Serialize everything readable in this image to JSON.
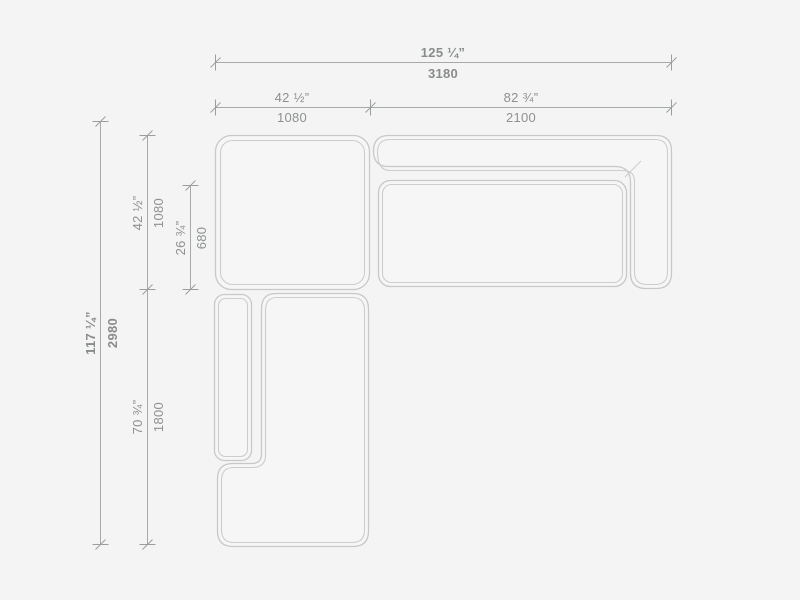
{
  "drawing": {
    "type": "sectional-sofa-top-view-dimension-drawing",
    "units": [
      "inches",
      "millimeters"
    ],
    "colors": {
      "background": "#f4f4f4",
      "furniture_line": "#c6c9c8",
      "dimension_line": "#a6aaa9",
      "label_text": "#8d918f"
    },
    "dimensions": {
      "overall_width": {
        "inches": "125 ¼”",
        "mm": "3180"
      },
      "left_width": {
        "inches": "42 ½”",
        "mm": "1080"
      },
      "right_width": {
        "inches": "82 ¾”",
        "mm": "2100"
      },
      "overall_depth": {
        "inches": "117 ¼”",
        "mm": "2980"
      },
      "corner_depth": {
        "inches": "42 ½”",
        "mm": "1080"
      },
      "seat_depth": {
        "inches": "26 ¾”",
        "mm": "680"
      },
      "chaise_length": {
        "inches": "70 ¾”",
        "mm": "1800"
      }
    },
    "modules": [
      "corner-module",
      "sofa-module-with-back-and-right-arm",
      "chaise-module-with-left-arm"
    ]
  }
}
